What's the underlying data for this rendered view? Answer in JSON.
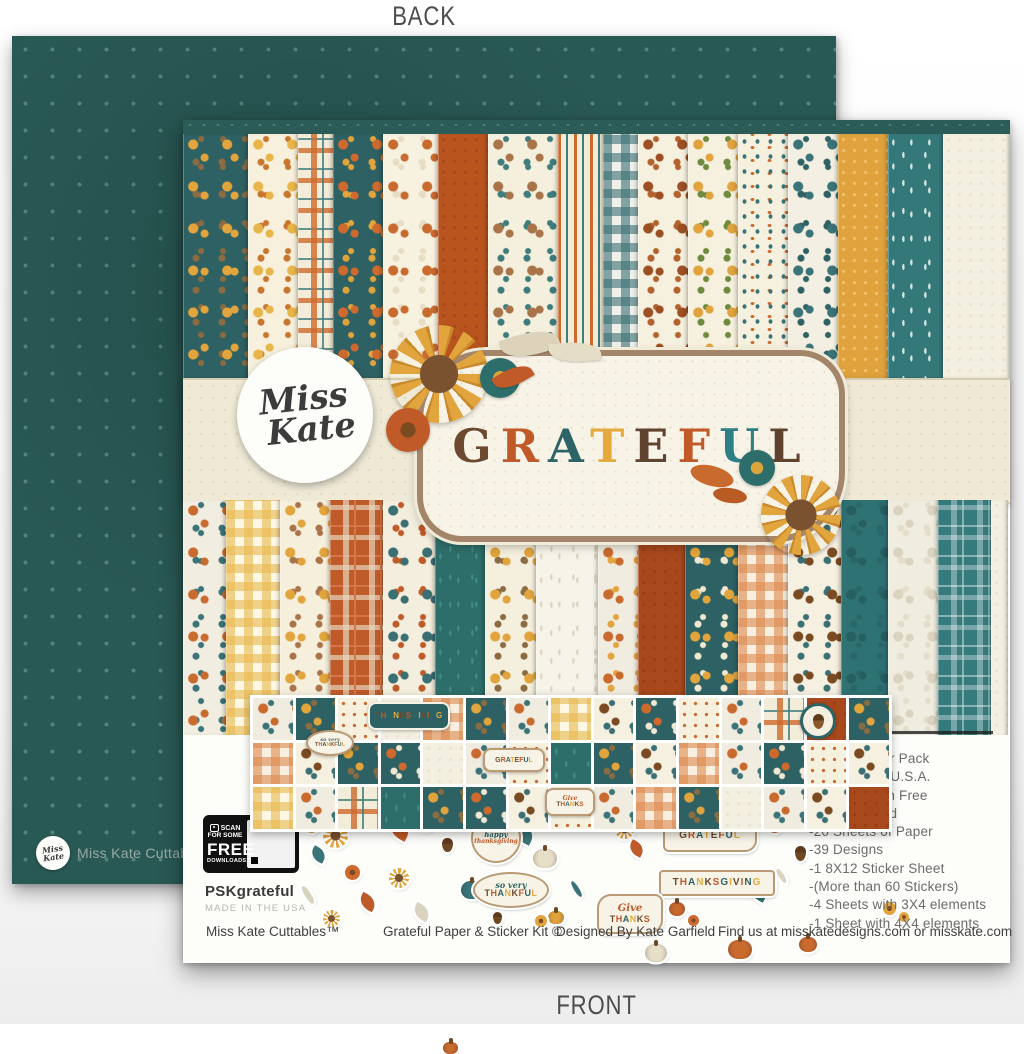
{
  "page": {
    "back_label": "BACK",
    "front_label": "FRONT"
  },
  "back_paper": {
    "brand": "Miss Kate Cuttables",
    "brand_tm": "™",
    "logo_script": "Miss Kate",
    "base_color": "#295955",
    "dot_color": "#55847e"
  },
  "front": {
    "logo": {
      "line1": "Miss",
      "line2": "Kate"
    },
    "title": {
      "word": "GRATEFUL",
      "letters": [
        {
          "ch": "G",
          "color": "#6b4a2f"
        },
        {
          "ch": "R",
          "color": "#c05a28"
        },
        {
          "ch": "A",
          "color": "#2d6466"
        },
        {
          "ch": "T",
          "color": "#e6a93c"
        },
        {
          "ch": "E",
          "color": "#5f432e"
        },
        {
          "ch": "F",
          "color": "#c05a28"
        },
        {
          "ch": "U",
          "color": "#2e7f86"
        },
        {
          "ch": "L",
          "color": "#5f432e"
        }
      ]
    },
    "qr": {
      "line1": "SCAN",
      "line2": "FOR SOME",
      "line3": "FREE",
      "line4": "DOWNLOADS!"
    },
    "sku": "PSKgrateful",
    "made_in": "MADE IN THE USA",
    "details": {
      "items": [
        "-12X12 Paper Pack",
        "-Made in the U.S.A.",
        "-Acid & Lignin Free",
        "-Double Sided",
        "-20 Sheets of Paper",
        "-39 Designs",
        "-1 8X12 Sticker Sheet",
        "-(More than 60 Stickers)",
        "-4 Sheets with 3X4 elements",
        "-1 Sheet with 4X4 elements"
      ]
    },
    "footer": {
      "brand": "Miss Kate Cuttables™",
      "product": "Grateful Paper & Sticker Kit ©",
      "designer": "Designed By Kate Garfield",
      "find_us": "Find us at misskatedesigns.com or misskate.com"
    },
    "sticker_words": {
      "thanksgiving": "THANKSGIVING",
      "grateful": "GRATEFUL",
      "give": "Give",
      "thanks": "THANKS",
      "so_very": "so very",
      "thankful": "THANKFUL",
      "happy": "happy",
      "thanksgiving_lc": "thanksgiving"
    },
    "letter_palette": [
      "#6b4a2f",
      "#c05a28",
      "#2d6466",
      "#e6a93c"
    ],
    "paper_strips": {
      "top": [
        {
          "name": "teal-sunflowers",
          "pattern": "floral",
          "base": "#2e6163",
          "a": "#e2a43c",
          "b": "#8a6b42",
          "w": 65
        },
        {
          "name": "cream-yellow-flowers",
          "pattern": "floral",
          "base": "#f7f0dc",
          "a": "#e8b54a",
          "b": "#c8762d",
          "w": 50
        },
        {
          "name": "autumn-plaid",
          "pattern": "plaid",
          "base": "#f3ecd9",
          "a": "#cf6a2ecc",
          "b": "#3f7d7ccc",
          "w": 35
        },
        {
          "name": "teal-dense-floral",
          "pattern": "floral",
          "base": "#2e6163",
          "a": "#cf6a2e",
          "b": "#e2a43c",
          "w": 50
        },
        {
          "name": "cream-pumpkins",
          "pattern": "floral",
          "base": "#f7f1e0",
          "a": "#c96a2f",
          "b": "#e7ddc4",
          "w": 55
        },
        {
          "name": "solid-rust-dots",
          "pattern": "dots",
          "base": "#b9541f",
          "a": "#a8491b",
          "w": 50
        },
        {
          "name": "cream-leaves-acorns",
          "pattern": "floral",
          "base": "#f5efdd",
          "a": "#a9744a",
          "b": "#3f7d7c",
          "w": 70
        },
        {
          "name": "autumn-stripes",
          "pattern": "stripes",
          "base": "#f3ecd9",
          "a": "#cf6a2e",
          "b": "#3f7d7c",
          "w": 45
        },
        {
          "name": "teal-gingham",
          "pattern": "gingham",
          "base": "#eef0e9",
          "a": "#3a6f7499",
          "w": 35
        },
        {
          "name": "cream-brown-seeds",
          "pattern": "floral",
          "base": "#f6f0de",
          "a": "#9c4f22",
          "b": "#b4622d",
          "w": 50
        },
        {
          "name": "cream-yellow-tulips",
          "pattern": "floral",
          "base": "#f6f0de",
          "a": "#e0a33e",
          "b": "#6d8a3f",
          "w": 50
        },
        {
          "name": "multicolor-dots",
          "pattern": "multidots",
          "base": "#f6f0de",
          "a": "#3a7478",
          "b": "#c96a2f",
          "w": 50
        },
        {
          "name": "cream-teal-flowers",
          "pattern": "floral",
          "base": "#f3efe2",
          "a": "#3a7478",
          "b": "#2e6163",
          "w": 50
        },
        {
          "name": "solid-mustard",
          "pattern": "dots",
          "base": "#dfa23d",
          "a": "#f0c06a",
          "w": 50
        },
        {
          "name": "teal-white-sprigs",
          "pattern": "sprigs",
          "base": "#35787a",
          "a": "#cfe3df",
          "w": 55
        },
        {
          "name": "plain-cream",
          "pattern": "dots",
          "base": "#f4f0e1",
          "a": "#e9e4d2",
          "w": 67
        }
      ],
      "bottom": [
        {
          "name": "cream-multi-pumpkins",
          "pattern": "floral",
          "base": "#f1ede0",
          "a": "#c96a2f",
          "b": "#3a7478",
          "w": 43
        },
        {
          "name": "yellow-gingham",
          "pattern": "gingham",
          "base": "#fdf7e3",
          "a": "#e8b84d99",
          "w": 54
        },
        {
          "name": "cream-sunflower-floral",
          "pattern": "floral",
          "base": "#f6efdc",
          "a": "#e2a43c",
          "b": "#a9744a",
          "w": 50
        },
        {
          "name": "rust-plaid",
          "pattern": "plaid",
          "base": "#bf5b28",
          "a": "#e8d9c2aa",
          "b": "#d4764a",
          "w": 53
        },
        {
          "name": "cream-maple-leaves",
          "pattern": "floral",
          "base": "#f3eedd",
          "a": "#3a6f74",
          "b": "#bf5b28",
          "w": 52
        },
        {
          "name": "teal-leaf-sprigs",
          "pattern": "sprigs",
          "base": "#2e6e6a",
          "a": "#3f8a82",
          "w": 50
        },
        {
          "name": "cream-sunflowers",
          "pattern": "floral",
          "base": "#f5efdd",
          "a": "#e2a43c",
          "b": "#8a6b42",
          "w": 51
        },
        {
          "name": "white-sprigs",
          "pattern": "sprigs",
          "base": "#f6f3e8",
          "a": "#ddd6c0",
          "w": 62
        },
        {
          "name": "cream-dense-floral",
          "pattern": "floral",
          "base": "#f1ece0",
          "a": "#c96a2f",
          "b": "#e2a43c",
          "w": 40
        },
        {
          "name": "solid-rust-brown",
          "pattern": "dots",
          "base": "#a8481d",
          "a": "#994016",
          "w": 47
        },
        {
          "name": "teal-pumpkins",
          "pattern": "floral",
          "base": "#2e6163",
          "a": "#e2a43c",
          "b": "#f0e8d2",
          "w": 53
        },
        {
          "name": "orange-gingham",
          "pattern": "gingham",
          "base": "#f8efe0",
          "a": "#dd8a4e99",
          "w": 50
        },
        {
          "name": "cream-acorns-leaves",
          "pattern": "floral",
          "base": "#f5f0e0",
          "a": "#7a4a21",
          "b": "#3a6f74",
          "w": 53
        },
        {
          "name": "teal-silhouette-floral",
          "pattern": "floral",
          "base": "#2f7274",
          "a": "#265f61",
          "b": "#2a6668",
          "w": 47
        },
        {
          "name": "beige-leaf-silhouettes",
          "pattern": "floral",
          "base": "#efece0",
          "a": "#d9d3bf",
          "b": "#e3ddc9",
          "w": 50
        },
        {
          "name": "teal-plaid",
          "pattern": "plaid",
          "base": "#357a7c",
          "a": "#ffffff55",
          "b": "#cfe3df88",
          "w": 53
        },
        {
          "name": "plain-edge",
          "pattern": "dots",
          "base": "#f4f0e1",
          "a": "#e9e4d2",
          "w": 17
        }
      ]
    },
    "mini_patterns": [
      {
        "pattern": "floral",
        "base": "#2e6163",
        "a": "#e2a43c",
        "b": "#8a6b42"
      },
      {
        "pattern": "dots",
        "base": "#f6f0de",
        "a": "#c96a2f"
      },
      {
        "pattern": "gingham",
        "base": "#f8efe0",
        "a": "#dd8a4e99"
      },
      {
        "pattern": "floral",
        "base": "#2e6163",
        "a": "#cf6a2e",
        "b": "#f0e8d2"
      },
      {
        "pattern": "floral",
        "base": "#f1ece0",
        "a": "#c96a2f",
        "b": "#3a7478"
      },
      {
        "pattern": "dots",
        "base": "#a8481d",
        "a": "#994016"
      },
      {
        "pattern": "gingham",
        "base": "#fdf7e3",
        "a": "#e8b84d99"
      },
      {
        "pattern": "sprigs",
        "base": "#2e6e6a",
        "a": "#3f8a82"
      },
      {
        "pattern": "floral",
        "base": "#f5f0e0",
        "a": "#7a4a21",
        "b": "#3a6f74"
      },
      {
        "pattern": "plaid",
        "base": "#f3ecd9",
        "a": "#cf6a2ecc",
        "b": "#3f7d7ccc"
      },
      {
        "pattern": "dots",
        "base": "#f4f0e1",
        "a": "#e9e4d2"
      },
      {
        "pattern": "stripes",
        "base": "#f3ecd9",
        "a": "#cf6a2e",
        "b": "#3f7d7c"
      }
    ],
    "sticker_tiles": [
      4,
      0,
      1,
      10,
      2,
      0,
      4,
      6,
      8,
      3,
      1,
      4,
      9,
      5,
      0,
      2,
      8,
      0,
      3,
      10,
      4,
      1,
      7,
      0,
      8,
      2,
      4,
      3,
      1,
      8,
      6,
      4,
      9,
      7,
      0,
      3,
      8,
      1,
      4,
      2,
      0,
      10,
      4,
      8,
      5
    ],
    "scatter": [
      {
        "shape": "flower",
        "x": 122,
        "y": 700,
        "s": 13,
        "c": "#e2a43c"
      },
      {
        "shape": "leaf",
        "x": 128,
        "y": 728,
        "s": 15,
        "c": "#3a7478"
      },
      {
        "shape": "sunflower",
        "x": 140,
        "y": 703,
        "s": 25,
        "c": "#e2a43c"
      },
      {
        "shape": "flower",
        "x": 162,
        "y": 745,
        "s": 15,
        "c": "#cf6a2e"
      },
      {
        "shape": "sprig",
        "x": 122,
        "y": 765,
        "s": 20,
        "c": "#d9d3bf"
      },
      {
        "shape": "leaf",
        "x": 176,
        "y": 775,
        "s": 17,
        "c": "#bf5b28"
      },
      {
        "shape": "leaf",
        "x": 206,
        "y": 700,
        "s": 21,
        "c": "#bf5b28"
      },
      {
        "shape": "pumpkin",
        "x": 233,
        "y": 695,
        "s": 19,
        "c": "#c96a2f"
      },
      {
        "shape": "acorn",
        "x": 259,
        "y": 718,
        "s": 14,
        "c": "#6f4722"
      },
      {
        "shape": "pumpkin",
        "x": 278,
        "y": 745,
        "s": 22,
        "c": "#3a7478"
      },
      {
        "shape": "sunflower",
        "x": 206,
        "y": 748,
        "s": 20,
        "c": "#e2a43c"
      },
      {
        "shape": "leaf",
        "x": 331,
        "y": 705,
        "s": 20,
        "c": "#3a7478"
      },
      {
        "shape": "pumpkin",
        "x": 350,
        "y": 695,
        "s": 24,
        "c": "#e8dfc8"
      },
      {
        "shape": "pumpkin",
        "x": 365,
        "y": 738,
        "s": 16,
        "c": "#e0a33e"
      },
      {
        "shape": "sprig",
        "x": 391,
        "y": 760,
        "s": 18,
        "c": "#3a7478"
      },
      {
        "shape": "flower",
        "x": 411,
        "y": 695,
        "s": 13,
        "c": "#e2a43c"
      },
      {
        "shape": "sunflower",
        "x": 432,
        "y": 700,
        "s": 19,
        "c": "#e2a43c"
      },
      {
        "shape": "leaf",
        "x": 446,
        "y": 722,
        "s": 15,
        "c": "#bf5b28"
      },
      {
        "shape": "pumpkin",
        "x": 462,
        "y": 758,
        "s": 22,
        "c": "#e8dfc8"
      },
      {
        "shape": "pumpkin",
        "x": 486,
        "y": 698,
        "s": 16,
        "c": "#c96a2f"
      },
      {
        "shape": "leaf",
        "x": 505,
        "y": 682,
        "s": 18,
        "c": "#d9d3bf"
      },
      {
        "shape": "sunflower",
        "x": 525,
        "y": 695,
        "s": 22,
        "c": "#e2a43c"
      },
      {
        "shape": "pumpkin",
        "x": 545,
        "y": 722,
        "s": 24,
        "c": "#c96a2f"
      },
      {
        "shape": "leaf",
        "x": 565,
        "y": 762,
        "s": 20,
        "c": "#2e6e6a"
      },
      {
        "shape": "flower",
        "x": 585,
        "y": 700,
        "s": 13,
        "c": "#cf6a2e"
      },
      {
        "shape": "sprig",
        "x": 602,
        "y": 690,
        "s": 19,
        "c": "#d9d3bf"
      },
      {
        "shape": "pumpkin",
        "x": 616,
        "y": 700,
        "s": 18,
        "c": "#c96a2f"
      },
      {
        "shape": "acorn",
        "x": 612,
        "y": 726,
        "s": 15,
        "c": "#6f4722"
      },
      {
        "shape": "flower",
        "x": 700,
        "y": 782,
        "s": 13,
        "c": "#e0a33e"
      },
      {
        "shape": "flower",
        "x": 716,
        "y": 792,
        "s": 10,
        "c": "#e0a33e"
      },
      {
        "shape": "sprig",
        "x": 596,
        "y": 748,
        "s": 16,
        "c": "#d9d3bf"
      },
      {
        "shape": "sunflower",
        "x": 140,
        "y": 790,
        "s": 17,
        "c": "#e2a43c"
      },
      {
        "shape": "leaf",
        "x": 230,
        "y": 785,
        "s": 17,
        "c": "#d9d3bf"
      },
      {
        "shape": "pumpkin",
        "x": 260,
        "y": 790,
        "s": 15,
        "c": "#c96a2f"
      },
      {
        "shape": "acorn",
        "x": 310,
        "y": 792,
        "s": 12,
        "c": "#6f4722"
      },
      {
        "shape": "flower",
        "x": 352,
        "y": 795,
        "s": 12,
        "c": "#e0a33e"
      },
      {
        "shape": "leaf",
        "x": 430,
        "y": 795,
        "s": 16,
        "c": "#3a7478"
      },
      {
        "shape": "flower",
        "x": 505,
        "y": 795,
        "s": 11,
        "c": "#cf6a2e"
      }
    ]
  }
}
